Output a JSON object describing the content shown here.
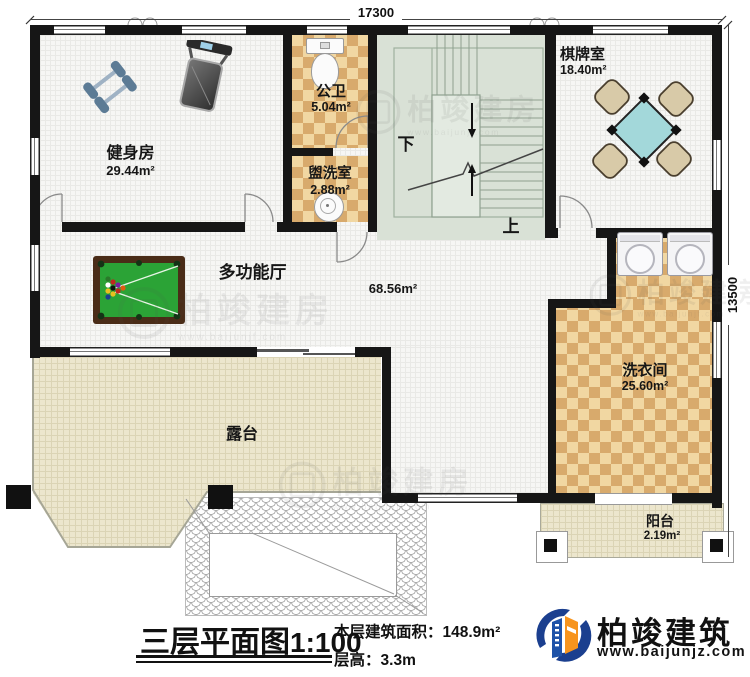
{
  "dimensions": {
    "width": "17300",
    "height": "13500"
  },
  "rooms": {
    "gym": {
      "name": "健身房",
      "area": "29.44m²"
    },
    "public_bath": {
      "name": "公卫",
      "area": "5.04m²"
    },
    "washroom": {
      "name": "盥洗室",
      "area": "2.88m²"
    },
    "chess": {
      "name": "棋牌室",
      "area": "18.40m²"
    },
    "hall": {
      "name": "多功能厅",
      "area": "68.56m²"
    },
    "laundry": {
      "name": "洗衣间",
      "area": "25.60m²"
    },
    "terrace": {
      "name": "露台"
    },
    "balcony": {
      "name": "阳台",
      "area": "2.19m²"
    }
  },
  "stairs": {
    "down": "下",
    "up": "上"
  },
  "title": {
    "name": "三层平面图",
    "scale": "1:100",
    "area_label": "本层建筑面积：",
    "area_value": "148.9m²",
    "floor_height_label": "层高：",
    "floor_height_value": "3.3m"
  },
  "brand": {
    "name": "柏竣建筑",
    "website": "www.baijunjz.com"
  },
  "watermark": {
    "text": "柏竣建房",
    "website": "www.baijunjf.com"
  }
}
